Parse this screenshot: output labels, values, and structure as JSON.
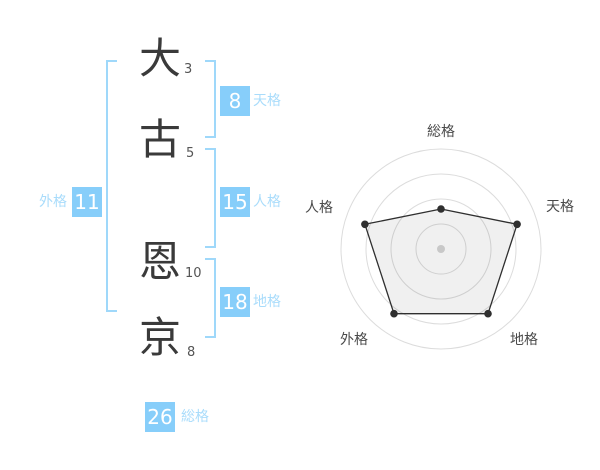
{
  "name_panel": {
    "characters": [
      {
        "char": "大",
        "strokes": "3"
      },
      {
        "char": "古",
        "strokes": "5"
      },
      {
        "char": "恩",
        "strokes": "10"
      },
      {
        "char": "京",
        "strokes": "8"
      }
    ],
    "scores": {
      "tenkaku": {
        "value": "8",
        "label": "天格"
      },
      "jinkaku": {
        "value": "15",
        "label": "人格"
      },
      "chikaku": {
        "value": "18",
        "label": "地格"
      },
      "gaikaku": {
        "value": "11",
        "label": "外格"
      },
      "soukaku": {
        "value": "26",
        "label": "総格"
      }
    }
  },
  "colors": {
    "badge_blue": "#87cefa",
    "bracket_blue": "#9fd8fa",
    "label_blue": "#a9dcfb",
    "text_dark": "#3a3a3a",
    "grid_gray": "#dcdcdc",
    "series_dark": "#2f2f2f",
    "center_dot_gray": "#c8c8c8"
  },
  "chart_data": {
    "type": "radar",
    "axes": [
      "総格",
      "天格",
      "地格",
      "外格",
      "人格"
    ],
    "values": [
      2,
      4,
      4,
      4,
      4
    ],
    "max": 5,
    "rings": 4,
    "grid": "circular",
    "legend_position": "none",
    "fill": "rgba(0,0,0,0.06)",
    "axis_order": "clockwise-from-top"
  }
}
